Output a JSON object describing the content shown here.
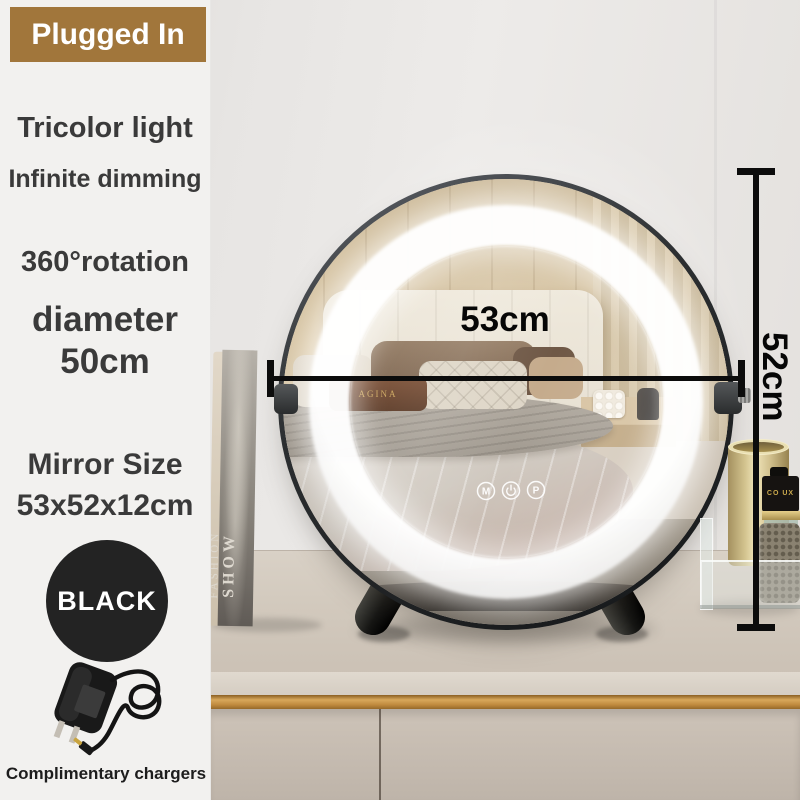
{
  "badge": {
    "label": "Plugged In"
  },
  "features": {
    "tricolor": "Tricolor light",
    "dimming": "Infinite dimming",
    "rotation": "360°rotation",
    "diameter_word": "diameter",
    "diameter_value": "50cm",
    "mirror_size_label": "Mirror Size",
    "mirror_size_value": "53x52x12cm"
  },
  "color_option": {
    "label": "BLACK"
  },
  "charger": {
    "caption": "Complimentary chargers"
  },
  "dimension_labels": {
    "width": "53cm",
    "height": "52cm"
  },
  "mirror_controls": {
    "mode": "M",
    "brightness": "P",
    "power_icon": "power-symbol"
  },
  "reflection": {
    "pillow_text": "AGINA"
  },
  "props": {
    "book_title_top": "FASHION",
    "book_title_bottom": "SHOW",
    "perfume_cap_text": "CO UX"
  },
  "colors": {
    "badge_bg": "#A1763B",
    "swatch_bg": "#232323",
    "gold_trim": "#C08A3E",
    "led_ring": "#FFFFFF",
    "text_ink": "#3A3A3A",
    "dimension_ink": "#0C0C0C"
  }
}
